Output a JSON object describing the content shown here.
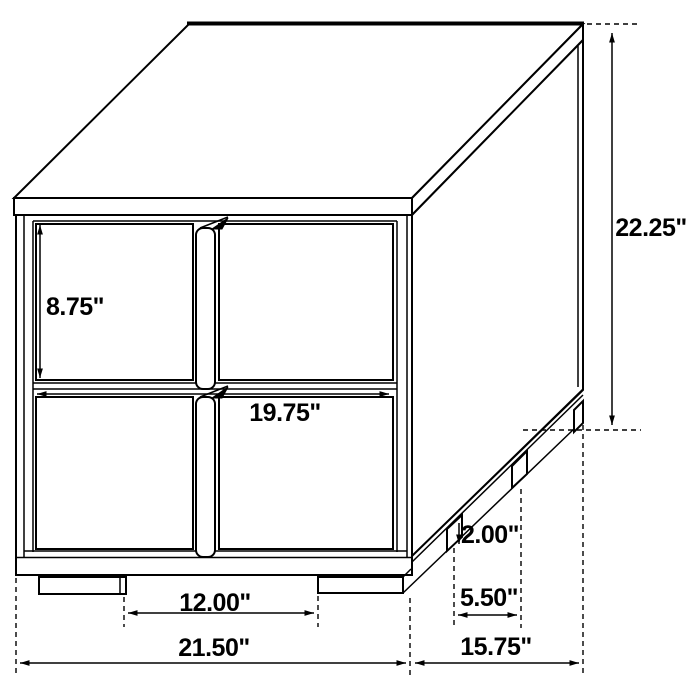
{
  "diagram": {
    "subject": "two-drawer nightstand dimensional line drawing",
    "background_color": "#ffffff",
    "line_color": "#000000",
    "dimensions": {
      "overall_height": "22.25\"",
      "drawer_face_height": "8.75\"",
      "drawer_width": "19.75\"",
      "foot_height": "2.00\"",
      "side_feet_gap": "5.50\"",
      "front_feet_gap": "12.00\"",
      "overall_width": "21.50\"",
      "overall_depth": "15.75\""
    }
  }
}
